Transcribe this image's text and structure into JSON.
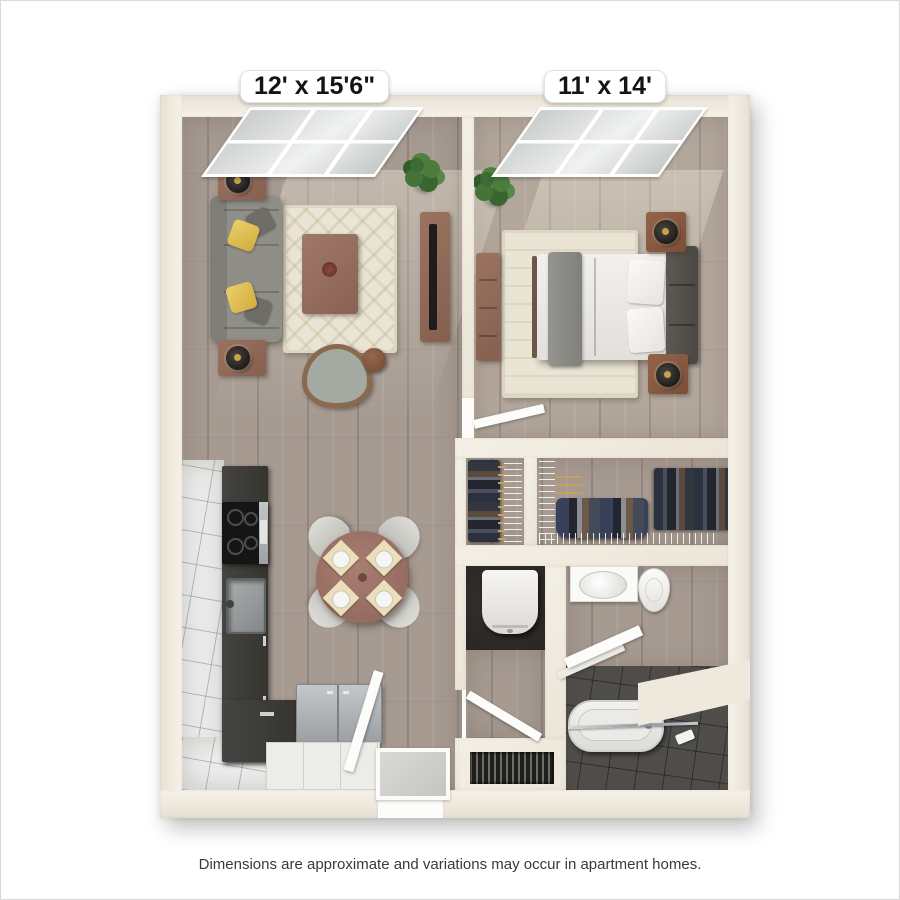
{
  "floor_plan": {
    "room_labels": [
      {
        "room": "living-room",
        "text": "12' x 15'6\""
      },
      {
        "room": "bedroom",
        "text": "11' x 14'"
      }
    ],
    "disclaimer": "Dimensions are approximate and variations may occur in apartment homes.",
    "colors": {
      "wall_cream": "#f0eadf",
      "wood_floor": "#a69a91",
      "bedroom_floor": "#b3a79c",
      "kitchen_tile": "#eceeed",
      "bath_dark_tile": "#504e4b",
      "counter_dark": "#3a3938",
      "sofa_gray": "#8d8c86",
      "accent_yellow": "#e3c251",
      "furniture_wood": "#96705f",
      "rug_cream": "#e9e4d4",
      "plant_green": "#4c7c3c",
      "label_text": "#141414"
    }
  }
}
